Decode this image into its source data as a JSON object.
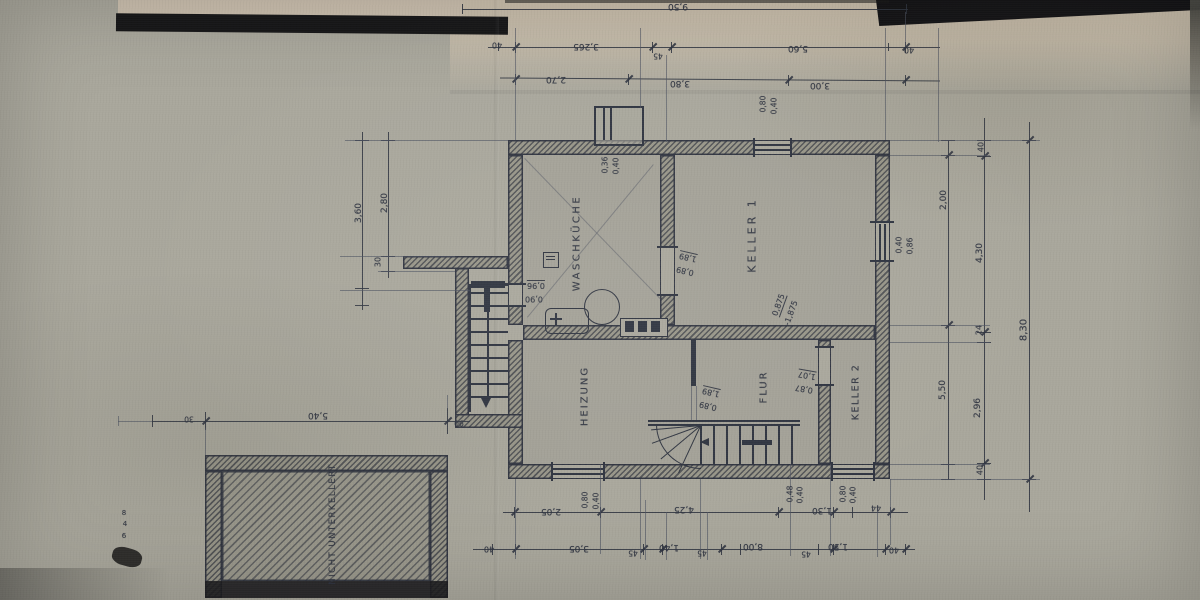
{
  "drawing": {
    "kind": "scanned hand-drawn architectural floor plan (basement / Kellergeschoss)",
    "language": "German"
  },
  "colors": {
    "paper": "#a9a79c",
    "ink": "#2f3440",
    "pencil": "#4d5260",
    "black": "#17171a"
  },
  "room_labels": [
    {
      "t": "WASCHKÜCHE",
      "x": 577,
      "y": 243,
      "r": -90,
      "fs": 10,
      "ls": 2.5,
      "n": "room-label-waschkueche"
    },
    {
      "t": "KELLER 1",
      "x": 752,
      "y": 235,
      "r": -90,
      "fs": 11,
      "ls": 3,
      "n": "room-label-keller-1"
    },
    {
      "t": "HEIZUNG",
      "x": 585,
      "y": 396,
      "r": -90,
      "fs": 10,
      "ls": 2,
      "n": "room-label-heizung"
    },
    {
      "t": "FLUR",
      "x": 764,
      "y": 387,
      "r": -90,
      "fs": 10,
      "ls": 2,
      "n": "room-label-flur"
    },
    {
      "t": "KELLER 2",
      "x": 856,
      "y": 392,
      "r": -90,
      "fs": 9.5,
      "ls": 1.5,
      "n": "room-label-keller-2"
    },
    {
      "t": "NICHT UNTERKELLERT",
      "x": 333,
      "y": 524,
      "r": -90,
      "fs": 8.5,
      "ls": 1.5,
      "n": "room-label-nicht-unterkellert"
    }
  ],
  "dim_texts": [
    {
      "t": "9,50",
      "x": 678,
      "y": 6,
      "r": 180,
      "fs": 9
    },
    {
      "t": "40",
      "x": 497,
      "y": 45,
      "r": 180,
      "fs": 8
    },
    {
      "t": "3,265",
      "x": 586,
      "y": 46,
      "r": 180,
      "fs": 9
    },
    {
      "t": "45",
      "x": 658,
      "y": 56,
      "r": 180,
      "fs": 7.5
    },
    {
      "t": "5,60",
      "x": 798,
      "y": 48,
      "r": 180,
      "fs": 9
    },
    {
      "t": "40",
      "x": 909,
      "y": 50,
      "r": 180,
      "fs": 8
    },
    {
      "t": "2,70",
      "x": 556,
      "y": 79,
      "r": 180,
      "fs": 9
    },
    {
      "t": "3,80",
      "x": 680,
      "y": 83,
      "r": 180,
      "fs": 9
    },
    {
      "t": "3,00",
      "x": 820,
      "y": 85,
      "r": 180,
      "fs": 9
    },
    {
      "t": "0,80",
      "x": 763,
      "y": 104,
      "r": -90,
      "fs": 7.5
    },
    {
      "t": "0,40",
      "x": 774,
      "y": 106,
      "r": -90,
      "fs": 7.5
    },
    {
      "t": "0,36",
      "x": 605,
      "y": 165,
      "r": -90,
      "fs": 7.5
    },
    {
      "t": "0,40",
      "x": 616,
      "y": 166,
      "r": -90,
      "fs": 7.5
    },
    {
      "t": "0,40",
      "x": 899,
      "y": 245,
      "r": -90,
      "fs": 7.5
    },
    {
      "t": "0,86",
      "x": 910,
      "y": 246,
      "r": -90,
      "fs": 7.5
    },
    {
      "t": "0,96",
      "x": 536,
      "y": 285,
      "r": 180,
      "fs": 8,
      "ul": 1
    },
    {
      "t": "0,90",
      "x": 534,
      "y": 299,
      "r": 180,
      "fs": 8
    },
    {
      "t": "1,89",
      "x": 688,
      "y": 257,
      "r": 193,
      "fs": 8,
      "ul": 1
    },
    {
      "t": "0,89",
      "x": 685,
      "y": 271,
      "r": 193,
      "fs": 8
    },
    {
      "t": "0,875",
      "x": 779,
      "y": 305,
      "r": -70,
      "fs": 8,
      "ul": 1
    },
    {
      "t": "-1,875",
      "x": 791,
      "y": 313,
      "r": -70,
      "fs": 8
    },
    {
      "t": "1,89",
      "x": 711,
      "y": 392,
      "r": 193,
      "fs": 8,
      "ul": 1
    },
    {
      "t": "0,89",
      "x": 708,
      "y": 406,
      "r": 193,
      "fs": 8
    },
    {
      "t": "1,07",
      "x": 807,
      "y": 375,
      "r": 190,
      "fs": 8,
      "ul": 1
    },
    {
      "t": "0,87",
      "x": 804,
      "y": 389,
      "r": 190,
      "fs": 8
    },
    {
      "t": "3,60",
      "x": 359,
      "y": 213,
      "r": -90,
      "fs": 9
    },
    {
      "t": "2,80",
      "x": 385,
      "y": 203,
      "r": -90,
      "fs": 9
    },
    {
      "t": "30",
      "x": 378,
      "y": 262,
      "r": -90,
      "fs": 8
    },
    {
      "t": "2,00",
      "x": 944,
      "y": 200,
      "r": -90,
      "fs": 9
    },
    {
      "t": "5,50",
      "x": 943,
      "y": 390,
      "r": -90,
      "fs": 9
    },
    {
      "t": "40",
      "x": 981,
      "y": 147,
      "r": -90,
      "fs": 8
    },
    {
      "t": "4,30",
      "x": 980,
      "y": 253,
      "r": -90,
      "fs": 9
    },
    {
      "t": "24",
      "x": 979,
      "y": 330,
      "r": -90,
      "fs": 8
    },
    {
      "t": "2,96",
      "x": 978,
      "y": 408,
      "r": -90,
      "fs": 9
    },
    {
      "t": "40",
      "x": 980,
      "y": 470,
      "r": -90,
      "fs": 8
    },
    {
      "t": "8,30",
      "x": 1024,
      "y": 330,
      "r": -90,
      "fs": 10
    },
    {
      "t": "5,40",
      "x": 318,
      "y": 415,
      "r": 180,
      "fs": 9
    },
    {
      "t": "30",
      "x": 189,
      "y": 419,
      "r": 180,
      "fs": 7.5
    },
    {
      "t": "90",
      "x": 459,
      "y": 423,
      "r": 180,
      "fs": 7.5
    },
    {
      "t": "8",
      "x": 124,
      "y": 513,
      "r": 0,
      "fs": 7
    },
    {
      "t": "4",
      "x": 125,
      "y": 524,
      "r": 0,
      "fs": 7
    },
    {
      "t": "6",
      "x": 124,
      "y": 536,
      "r": 0,
      "fs": 7
    },
    {
      "t": "2,05",
      "x": 551,
      "y": 511,
      "r": 180,
      "fs": 9
    },
    {
      "t": "4,25",
      "x": 684,
      "y": 509,
      "r": 180,
      "fs": 9
    },
    {
      "t": "1,30",
      "x": 822,
      "y": 510,
      "r": 180,
      "fs": 9
    },
    {
      "t": "44",
      "x": 876,
      "y": 508,
      "r": 180,
      "fs": 8
    },
    {
      "t": "0,80",
      "x": 585,
      "y": 500,
      "r": -90,
      "fs": 7.5
    },
    {
      "t": "0,40",
      "x": 596,
      "y": 501,
      "r": -90,
      "fs": 7.5
    },
    {
      "t": "0,48",
      "x": 790,
      "y": 494,
      "r": -90,
      "fs": 7.5
    },
    {
      "t": "0,40",
      "x": 800,
      "y": 495,
      "r": -90,
      "fs": 7.5
    },
    {
      "t": "0,80",
      "x": 843,
      "y": 494,
      "r": -90,
      "fs": 7.5
    },
    {
      "t": "0,40",
      "x": 853,
      "y": 495,
      "r": -90,
      "fs": 7.5
    },
    {
      "t": "40",
      "x": 489,
      "y": 549,
      "r": 180,
      "fs": 8
    },
    {
      "t": "3,05",
      "x": 579,
      "y": 548,
      "r": 180,
      "fs": 9
    },
    {
      "t": "45",
      "x": 633,
      "y": 553,
      "r": 180,
      "fs": 7.5
    },
    {
      "t": "1,40",
      "x": 669,
      "y": 547,
      "r": 180,
      "fs": 9
    },
    {
      "t": "45",
      "x": 702,
      "y": 553,
      "r": 180,
      "fs": 7.5
    },
    {
      "t": "8,00",
      "x": 753,
      "y": 546,
      "r": 180,
      "fs": 9
    },
    {
      "t": "45",
      "x": 806,
      "y": 554,
      "r": 180,
      "fs": 7.5
    },
    {
      "t": "1,50",
      "x": 838,
      "y": 546,
      "r": 180,
      "fs": 9
    },
    {
      "t": "40",
      "x": 894,
      "y": 550,
      "r": 180,
      "fs": 8
    }
  ]
}
